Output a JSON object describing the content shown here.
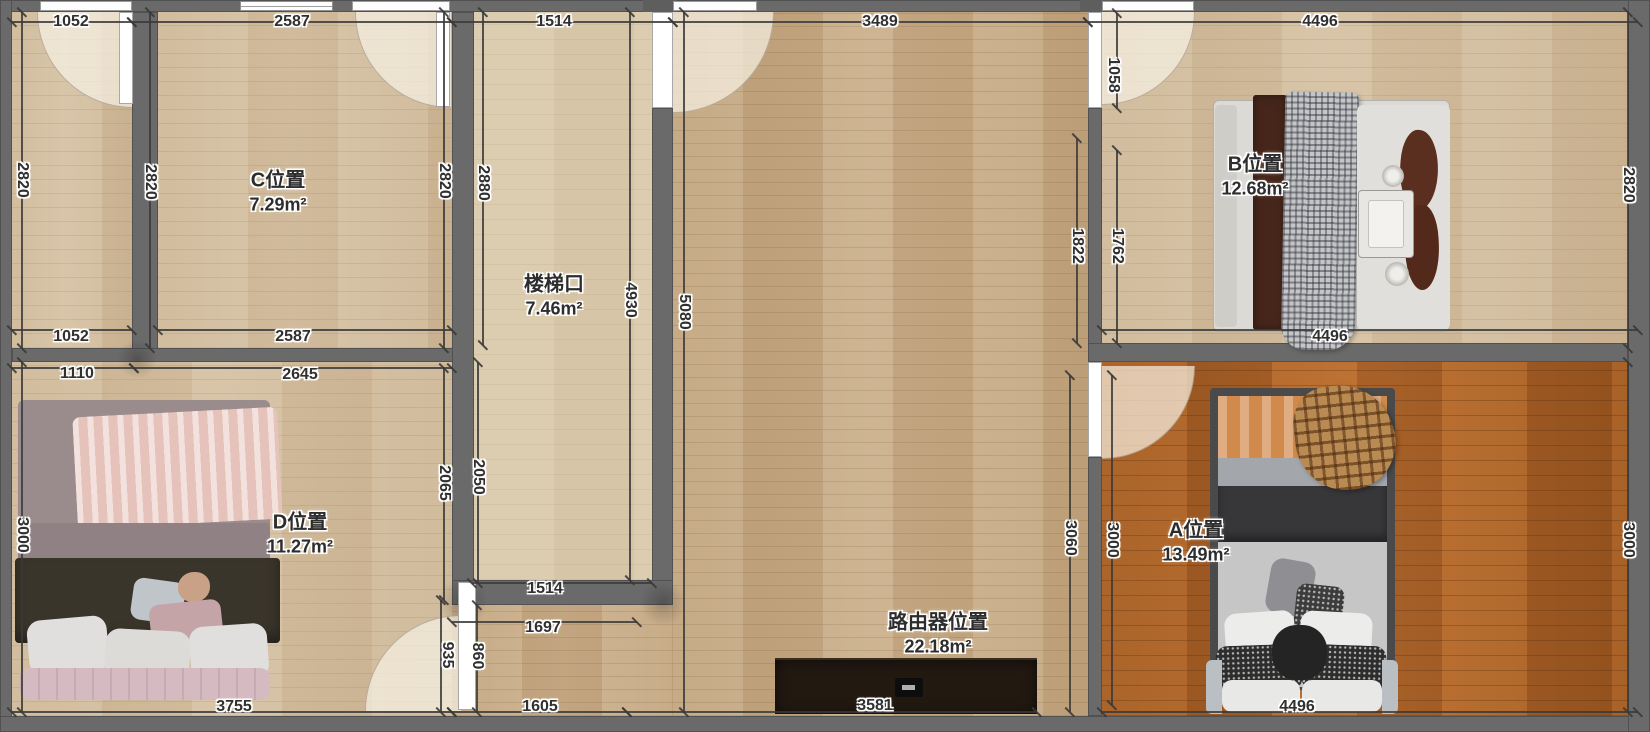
{
  "title": "apartment floor plan",
  "colors": {
    "background": "#8d8d8d",
    "wall": "#6a6a6a",
    "floor_light_wood": "#d4bf9f",
    "floor_hall": "#c9ad87",
    "floor_stairs": "#dacaac",
    "floor_room_a": "#ad6327"
  },
  "rooms": [
    {
      "name": "C位置",
      "area": "7.29m²",
      "x": 278,
      "y": 192
    },
    {
      "name": "楼梯口",
      "area": "7.46m²",
      "x": 554,
      "y": 296
    },
    {
      "name": "B位置",
      "area": "12.68m²",
      "x": 1255,
      "y": 176
    },
    {
      "name": "D位置",
      "area": "11.27m²",
      "x": 300,
      "y": 534
    },
    {
      "name": "A位置",
      "area": "13.49m²",
      "x": 1196,
      "y": 542
    },
    {
      "name": "路由器位置",
      "area": "22.18m²",
      "x": 938,
      "y": 634
    }
  ],
  "dimension_labels": [
    {
      "text": "1052",
      "x": 71,
      "y": 22,
      "rot": 0
    },
    {
      "text": "2587",
      "x": 292,
      "y": 22,
      "rot": 0
    },
    {
      "text": "1514",
      "x": 554,
      "y": 22,
      "rot": 0
    },
    {
      "text": "3489",
      "x": 880,
      "y": 22,
      "rot": 0
    },
    {
      "text": "4496",
      "x": 1320,
      "y": 22,
      "rot": 0
    },
    {
      "text": "2820",
      "x": 22,
      "y": 180,
      "rot": 90
    },
    {
      "text": "3000",
      "x": 22,
      "y": 535,
      "rot": 90
    },
    {
      "text": "2820",
      "x": 150,
      "y": 182,
      "rot": 90
    },
    {
      "text": "2820",
      "x": 444,
      "y": 181,
      "rot": 90
    },
    {
      "text": "2880",
      "x": 483,
      "y": 183,
      "rot": 90
    },
    {
      "text": "4930",
      "x": 630,
      "y": 300,
      "rot": 90
    },
    {
      "text": "5080",
      "x": 684,
      "y": 312,
      "rot": 90
    },
    {
      "text": "1052",
      "x": 71,
      "y": 337,
      "rot": 0
    },
    {
      "text": "2587",
      "x": 293,
      "y": 337,
      "rot": 0
    },
    {
      "text": "1110",
      "x": 77,
      "y": 374,
      "rot": 0
    },
    {
      "text": "2645",
      "x": 300,
      "y": 375,
      "rot": 0
    },
    {
      "text": "4496",
      "x": 1330,
      "y": 337,
      "rot": 0
    },
    {
      "text": "1058",
      "x": 1113,
      "y": 75,
      "rot": 90
    },
    {
      "text": "1822",
      "x": 1077,
      "y": 246,
      "rot": 90
    },
    {
      "text": "1762",
      "x": 1117,
      "y": 246,
      "rot": 90
    },
    {
      "text": "2820",
      "x": 1628,
      "y": 185,
      "rot": 90
    },
    {
      "text": "2065",
      "x": 444,
      "y": 483,
      "rot": 90
    },
    {
      "text": "2050",
      "x": 478,
      "y": 477,
      "rot": 90
    },
    {
      "text": "1514",
      "x": 545,
      "y": 589,
      "rot": 0
    },
    {
      "text": "1697",
      "x": 543,
      "y": 628,
      "rot": 0
    },
    {
      "text": "935",
      "x": 447,
      "y": 655,
      "rot": 90
    },
    {
      "text": "860",
      "x": 477,
      "y": 656,
      "rot": 90
    },
    {
      "text": "3060",
      "x": 1070,
      "y": 538,
      "rot": 90
    },
    {
      "text": "3000",
      "x": 1112,
      "y": 540,
      "rot": 90
    },
    {
      "text": "3000",
      "x": 1628,
      "y": 540,
      "rot": 90
    },
    {
      "text": "3755",
      "x": 234,
      "y": 707,
      "rot": 0
    },
    {
      "text": "1605",
      "x": 540,
      "y": 707,
      "rot": 0
    },
    {
      "text": "3581",
      "x": 875,
      "y": 706,
      "rot": 0
    },
    {
      "text": "4496",
      "x": 1297,
      "y": 707,
      "rot": 0
    }
  ],
  "dimension_lines": [
    [
      12,
      22,
      132,
      22
    ],
    [
      132,
      22,
      452,
      22
    ],
    [
      452,
      22,
      673,
      22
    ],
    [
      673,
      22,
      1088,
      22
    ],
    [
      1088,
      22,
      1638,
      22
    ],
    [
      12,
      330,
      132,
      330
    ],
    [
      158,
      330,
      452,
      330
    ],
    [
      12,
      368,
      134,
      368
    ],
    [
      134,
      368,
      452,
      368
    ],
    [
      1102,
      330,
      1638,
      330
    ],
    [
      472,
      583,
      652,
      583
    ],
    [
      452,
      622,
      637,
      622
    ],
    [
      12,
      712,
      452,
      712
    ],
    [
      452,
      712,
      627,
      712
    ],
    [
      627,
      712,
      1037,
      712
    ],
    [
      1102,
      712,
      1638,
      712
    ],
    [
      22,
      12,
      22,
      348
    ],
    [
      22,
      362,
      22,
      712
    ],
    [
      150,
      12,
      150,
      348
    ],
    [
      444,
      12,
      444,
      348
    ],
    [
      483,
      12,
      483,
      345
    ],
    [
      630,
      12,
      630,
      580
    ],
    [
      684,
      12,
      684,
      712
    ],
    [
      444,
      368,
      444,
      600
    ],
    [
      478,
      362,
      478,
      583
    ],
    [
      441,
      600,
      441,
      712
    ],
    [
      477,
      605,
      477,
      712
    ],
    [
      1117,
      13,
      1117,
      108
    ],
    [
      1077,
      138,
      1077,
      343
    ],
    [
      1117,
      150,
      1117,
      343
    ],
    [
      1070,
      375,
      1070,
      712
    ],
    [
      1112,
      375,
      1112,
      705
    ],
    [
      1628,
      12,
      1628,
      348
    ],
    [
      1628,
      362,
      1628,
      712
    ]
  ]
}
